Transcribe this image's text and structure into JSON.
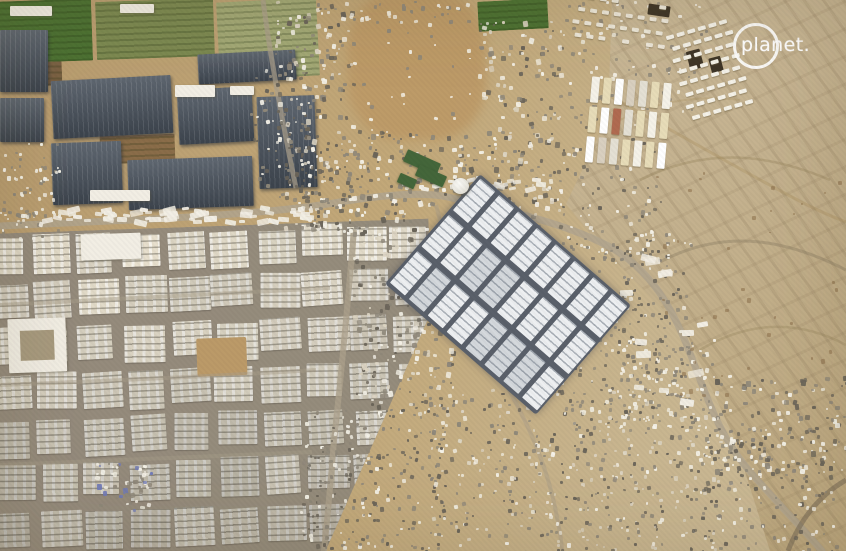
{
  "watermark": {
    "logo_text": "planet."
  },
  "scene": {
    "type": "satellite-photo",
    "features": [
      {
        "name": "greenhouse-farms",
        "desc": "green fields and dark greenhouse blocks, top left"
      },
      {
        "name": "city-blocks",
        "desc": "dense grid of light urban blocks, bottom left"
      },
      {
        "name": "warehouse-compound",
        "desc": "rows of white warehouses rotated diagonally, center"
      },
      {
        "name": "tent-camps",
        "desc": "organized tent grids and scattered shelters on sand"
      },
      {
        "name": "desert-dunes",
        "desc": "open sandy dune area, right side"
      }
    ],
    "colors": {
      "sand": "#c0ad88",
      "sand_light": "#ccbb98",
      "sand_warm": "#b89c6f",
      "field_dirt": "#8a6d49",
      "green_field": "#4d7233",
      "green_field_olive": "#7d8a52",
      "green_field_pale": "#a3a976",
      "greenhouse": "#49525d",
      "greenhouse_stripe": "#57616d",
      "urban_street": "#928a7c",
      "building_cream": "#ded6c4",
      "building_white": "#f2eee4",
      "warehouse_white": "#edeff1",
      "warehouse_gap": "#5a606a",
      "road": "#b0a48e",
      "tarp_blue": "#6f79b8",
      "tent_white": "#f5f2e8",
      "tent_cream": "#e7dcb8",
      "tent_red": "#b06a50",
      "shadow_dark": "#6b655a",
      "speck_gray": "#8f887a",
      "dark_structure": "#3f3628",
      "green_roof": "#44663a",
      "logo": "#ffffff"
    }
  }
}
